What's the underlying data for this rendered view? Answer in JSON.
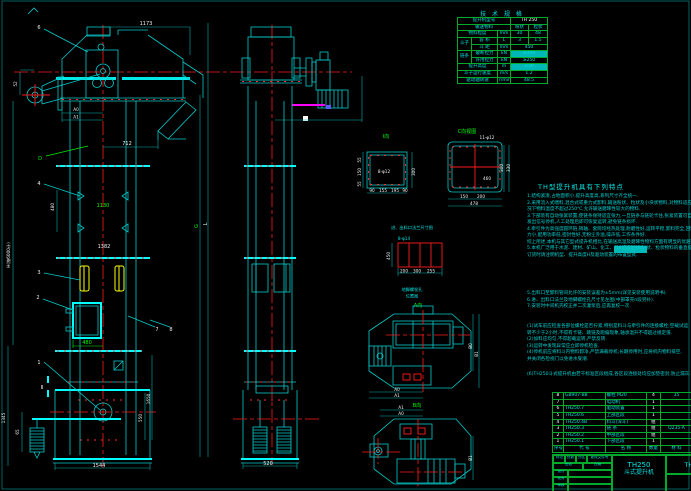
{
  "spec": {
    "title": "技 术 规 格",
    "r0l": "提升机型号",
    "r0v": "TH 250",
    "r1l": "输送物料",
    "r1a": "粉状",
    "r1b": "粒状",
    "r2l": "物料粒度",
    "r2u": "mm",
    "r2a": "30",
    "r2b": "48",
    "g1": "斗子",
    "r3l": "容 积",
    "r3u": "L",
    "r3a": "3",
    "r3b": "1.5",
    "r4l": "斗 距",
    "r4u": "mm",
    "r4v": "450",
    "g2": "链条",
    "r5l": "破断拉力",
    "r5u": "kN",
    "r5v": "≥350",
    "r6l": "许用拉力",
    "r6u": "kN",
    "r6v": "≥250",
    "r7l": "提升高度",
    "r7u": "m",
    "r7v": "≤30",
    "r8l": "斗子运行速度",
    "r8u": "m/s",
    "r8v": "1.2",
    "r9l": "驱动轴转速",
    "r9u": "r/min",
    "r9v": "48.5"
  },
  "notes": {
    "title": "TH型提升机具有下列特点",
    "hl": "(详见选型样本)",
    "linesA": [
      "1.结构紧凑,占地面积小,提升高度高,系列尺寸齐全统一.",
      "2.采用流入式喂料,混合式或重力式卸料,输送粉状、粒状及小块状物料,对物料适应性强,一般情",
      "  况下物料温度不超过250℃,允许输送磨琢性较大的物料.",
      "3.下部装有自动张紧装置,使链条保持适宜张力,一旦链条与链轮卡住,张紧装置可自动让位,并",
      "  发出信号停机,人工处理后即可恢复运转,避免链条损坏.",
      "4.牵引件为高强度圆环链,销轴、套筒均经热处理,耐磨性好,运转平稳,卸料完全,回料少,工作阻",
      "  力小,配用功率低,密封性好,无粉尘外溢,噪声低,工作条件好.",
      "  综上所述,本机与其它型式提升机相比,在输送高温及磨琢性物料方面有明显的优越性.",
      "5.本机广泛用于水泥、建材、矿山、化工、粮食等部门作粉状、粒状物料的垂直提升",
      "  订货时请注明机型、提升高度H及驱动装置的布置型式."
    ],
    "linesB": [
      "5.出料口至卸料管间允许的安装误差为±5mm(详见安装使用说明书).",
      "6.进、出料口法兰及地脚螺栓孔尺寸见左图(中部罩壳п段另补).",
      "7.安装时中间机壳校正并二次灌浆后,应再复校一次."
    ],
    "linesC": [
      "(1)试车前应检查各部位螺栓是否拧紧,特别是料斗与牵引件的连接螺栓;空载试运",
      "  转不少于2小时,不得有卡链、跳链及跑偏现象,轴承温升不得超过规定值.",
      "(2)加料应均匀,不得超载运转,严禁反转.",
      "(3)运转中发现异常应立即停机检查.",
      "(4)停机前应将料斗内物料卸净,严禁满载停机;长期停用时,应将机内物料排空,",
      "  并关闭各检视门以免进水受潮."
    ],
    "linesD": [
      "(6)TH250斗式提升机由若干标准区段组成,各区段连接处均应加垫密封,防止漏灰."
    ]
  },
  "dims": {
    "d1173": "1173",
    "d52": "52",
    "dA0": "A0",
    "dA1": "A1",
    "d712": "712",
    "dD": "D",
    "d480a": "480",
    "d1130": "1130",
    "d1382": "1382",
    "dG": "G",
    "dL": "L",
    "dH": "H(按6000计)",
    "d480b": "480",
    "d550": "550",
    "d1650": "1650",
    "d1345": "1345",
    "d65": "65",
    "d1544": "1544",
    "d520": "520"
  },
  "co": {
    "n1": "1",
    "n2": "2",
    "n3": "3",
    "n4": "4",
    "n6": "6",
    "n7": "7",
    "n8": "8",
    "sec": "Ⅱ"
  },
  "det": {
    "lI": "Ⅰ向",
    "holesI": "8-φ12",
    "d300": "300",
    "b90a": "90",
    "b155": "155",
    "b195": "195",
    "b90b": "90",
    "l55a": "55",
    "l150": "150",
    "l55b": "55",
    "lC": "C向视图",
    "holesC": "11-φ12",
    "c300": "300",
    "c330": "330",
    "c460": "460",
    "c150": "150",
    "c200": "200",
    "c478": "478",
    "capF": "进、出料口法兰尺寸图",
    "holesA": "8-φ14",
    "a450": "450",
    "a200": "200",
    "a300": "300",
    "a255": "255",
    "capA1": "地脚螺栓孔",
    "capA2": "位置图",
    "lA": "A向",
    "lB": "B向",
    "pA0": "A0",
    "pA1": "A1",
    "pB0": "B0",
    "pB1": "B1"
  },
  "parts": {
    "headers": [
      "序号",
      "代    号",
      "名    称",
      "数量",
      "材  料",
      "备注"
    ],
    "rows": [
      [
        "8",
        "GB907-88",
        "螺栓 M20",
        "4",
        "35",
        "配对"
      ],
      [
        "7",
        "",
        "电动机",
        "1",
        "",
        "购件"
      ],
      [
        "6",
        "TH250.7",
        "驱动装置",
        "1",
        "",
        "组装件"
      ],
      [
        "5",
        "TH250.6",
        "上部区段",
        "1",
        "",
        "焊接件"
      ],
      [
        "4",
        "TH250.4B",
        "料斗(深斗)",
        "组",
        "",
        "冲压件"
      ],
      [
        "3",
        "TH250.3",
        "链 条",
        "组",
        "Q235-A",
        "20节"
      ],
      [
        "2",
        "TH250.2",
        "中部区段",
        "组",
        "",
        "焊接件"
      ],
      [
        "1",
        "TH250.1",
        "下部区段",
        "1",
        "",
        "焊接件"
      ]
    ]
  },
  "tb": {
    "model": "TH250",
    "name": "斗式提升机",
    "dwg": "TH250",
    "s1": "标记",
    "s2": "处数",
    "s3": "分区",
    "s4": "更改文件号",
    "s5": "签名",
    "s6": "日期",
    "d1": "设计",
    "d2": "校对",
    "d3": "审核",
    "d4": "批准"
  }
}
